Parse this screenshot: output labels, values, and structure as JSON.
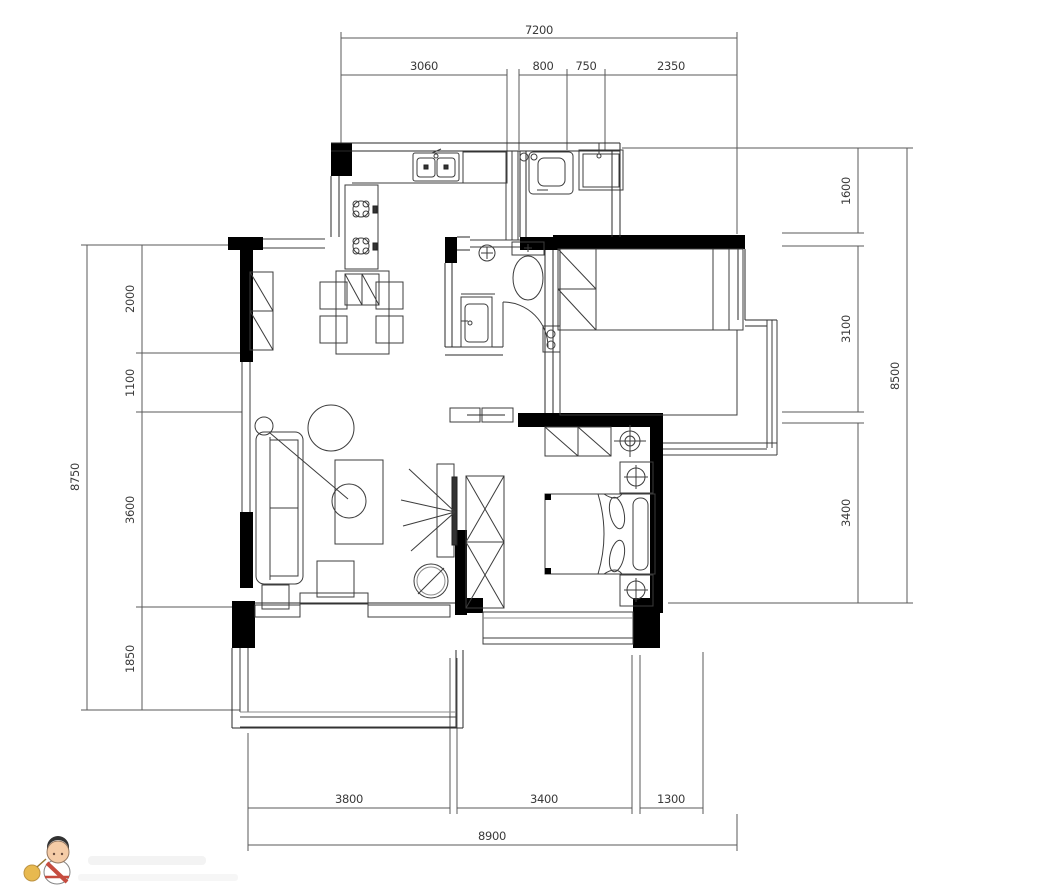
{
  "dimensions": {
    "top": {
      "overall": "7200",
      "segments": [
        "3060",
        "800",
        "750",
        "2350"
      ]
    },
    "left": {
      "overall": "8750",
      "segments": [
        "2000",
        "1100",
        "3600",
        "1850"
      ]
    },
    "right": {
      "overall": "8500",
      "segments": [
        "1600",
        "3100",
        "3400"
      ]
    },
    "bottom": {
      "overall": "8900",
      "segments": [
        "3800",
        "3400",
        "1300"
      ]
    }
  },
  "colors": {
    "background": "#ffffff",
    "walls": "#000000",
    "lines": "#3c3c3c",
    "dimension_lines": "#5a5a5a",
    "watermark_sash": "#c0392b",
    "watermark_ball": "#e6b23c",
    "watermark_skin": "#f4c79e"
  },
  "symbols": {
    "kitchen": [
      "counter",
      "double-sink-icon",
      "gas-stove-icon",
      "cabinet-icon"
    ],
    "utility": [
      "washing-machine-icon",
      "utility-sink-icon",
      "vent-icon",
      "sliding-door-icon"
    ],
    "bathroom": [
      "toilet-icon",
      "washbasin-icon",
      "floor-drain-icon",
      "door-swing-icon",
      "panel-icon"
    ],
    "living_dining": [
      "dining-table-icon",
      "chair-icon",
      "sofa-icon",
      "coffee-table-icon",
      "floor-lamp-icon",
      "plant-icon",
      "tv-icon",
      "stool-icon",
      "side-table-icon"
    ],
    "master_bedroom": [
      "double-bed-icon",
      "pillow-icon",
      "wardrobe-icon",
      "nightstand-icon",
      "ceiling-lamp-icon",
      "bay-window",
      "cabinet-icon"
    ],
    "second_bedroom": [
      "single-bed-icon",
      "wardrobe-icon",
      "platform-bed",
      "bay-window"
    ],
    "balcony": [
      "window-band",
      "sliding-door-icon"
    ]
  }
}
